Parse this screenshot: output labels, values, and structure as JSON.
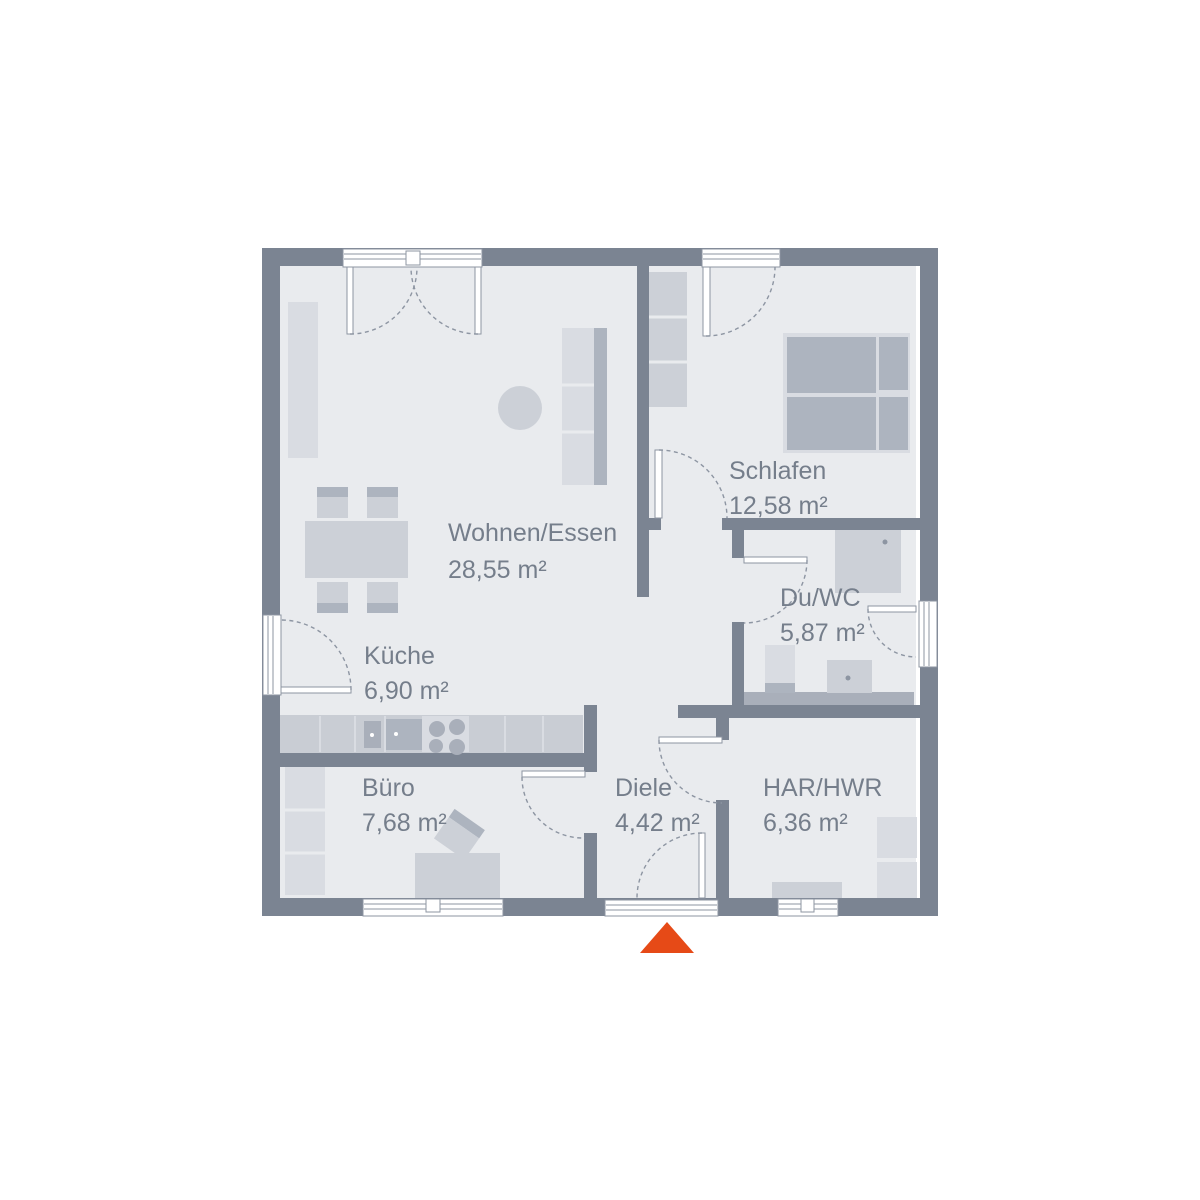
{
  "colors": {
    "wall": "#7b8492",
    "floor": "#e9ebee",
    "window": "#ffffff",
    "outline": "#8d95a2",
    "furniture_light": "#d9dce2",
    "furniture_mid": "#ccd0d7",
    "furniture_dark": "#adb4bf",
    "counter": "#c9cdd4",
    "fixture": "#a9afba",
    "label": "#757e8b",
    "accent": "#e64a17"
  },
  "floorplan": {
    "type": "bungalow-floor-plan",
    "rooms": [
      {
        "id": "wohnen-essen",
        "name": "Wohnen/Essen",
        "area": "28,55 m²"
      },
      {
        "id": "schlafen",
        "name": "Schlafen",
        "area": "12,58 m²"
      },
      {
        "id": "du-wc",
        "name": "Du/WC",
        "area": "5,87 m²"
      },
      {
        "id": "kueche",
        "name": "Küche",
        "area": "6,90 m²"
      },
      {
        "id": "buero",
        "name": "Büro",
        "area": "7,68 m²"
      },
      {
        "id": "diele",
        "name": "Diele",
        "area": "4,42 m²"
      },
      {
        "id": "har-hwr",
        "name": "HAR/HWR",
        "area": "6,36 m²"
      }
    ],
    "entrance": {
      "icon": "triangle-up",
      "position": "bottom-center"
    }
  }
}
